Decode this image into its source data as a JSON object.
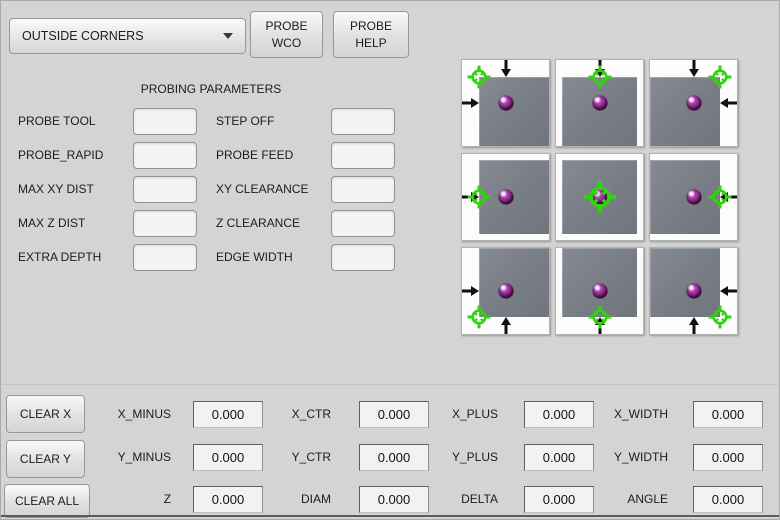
{
  "toolbar": {
    "mode_select": {
      "value": "OUTSIDE CORNERS"
    },
    "probe_wco_label": "PROBE\nWCO",
    "probe_help_label": "PROBE\nHELP"
  },
  "parameters": {
    "title": "PROBING PARAMETERS",
    "fields": [
      {
        "label": "PROBE TOOL",
        "value": ""
      },
      {
        "label": "STEP OFF",
        "value": ""
      },
      {
        "label": "PROBE_RAPID",
        "value": ""
      },
      {
        "label": "PROBE FEED",
        "value": ""
      },
      {
        "label": "MAX XY DIST",
        "value": ""
      },
      {
        "label": "XY CLEARANCE",
        "value": ""
      },
      {
        "label": "MAX Z DIST",
        "value": ""
      },
      {
        "label": "Z CLEARANCE",
        "value": ""
      },
      {
        "label": "EXTRA DEPTH",
        "value": ""
      },
      {
        "label": "EDGE WIDTH",
        "value": ""
      }
    ]
  },
  "probe_grid": {
    "colors": {
      "target_green": "#30d40e",
      "workpiece_gray": "#787d85",
      "sphere_purple": "#7c1d7c",
      "arrow_black": "#111111"
    },
    "cells": [
      {
        "id": "top-left-corner",
        "pos": "tl",
        "arrows": [
          "down",
          "right"
        ]
      },
      {
        "id": "top-edge",
        "pos": "t",
        "arrows": [
          "down"
        ]
      },
      {
        "id": "top-right-corner",
        "pos": "tr",
        "arrows": [
          "down",
          "left"
        ]
      },
      {
        "id": "left-edge",
        "pos": "l",
        "arrows": [
          "right"
        ]
      },
      {
        "id": "center",
        "pos": "c",
        "arrows": []
      },
      {
        "id": "right-edge",
        "pos": "r",
        "arrows": [
          "left"
        ]
      },
      {
        "id": "bottom-left-corner",
        "pos": "bl",
        "arrows": [
          "right",
          "up"
        ]
      },
      {
        "id": "bottom-edge",
        "pos": "b",
        "arrows": [
          "up"
        ]
      },
      {
        "id": "bottom-right-corner",
        "pos": "br",
        "arrows": [
          "left",
          "up"
        ]
      }
    ]
  },
  "results": {
    "clear_buttons": [
      {
        "label": "CLEAR X"
      },
      {
        "label": "CLEAR Y"
      },
      {
        "label": "CLEAR ALL"
      }
    ],
    "rows": [
      {
        "cells": [
          {
            "label": "X_MINUS",
            "value": "0.000"
          },
          {
            "label": "X_CTR",
            "value": "0.000"
          },
          {
            "label": "X_PLUS",
            "value": "0.000"
          },
          {
            "label": "X_WIDTH",
            "value": "0.000"
          }
        ]
      },
      {
        "cells": [
          {
            "label": "Y_MINUS",
            "value": "0.000"
          },
          {
            "label": "Y_CTR",
            "value": "0.000"
          },
          {
            "label": "Y_PLUS",
            "value": "0.000"
          },
          {
            "label": "Y_WIDTH",
            "value": "0.000"
          }
        ]
      },
      {
        "cells": [
          {
            "label": "Z",
            "value": "0.000"
          },
          {
            "label": "DIAM",
            "value": "0.000"
          },
          {
            "label": "DELTA",
            "value": "0.000"
          },
          {
            "label": "ANGLE",
            "value": "0.000"
          }
        ]
      }
    ]
  }
}
